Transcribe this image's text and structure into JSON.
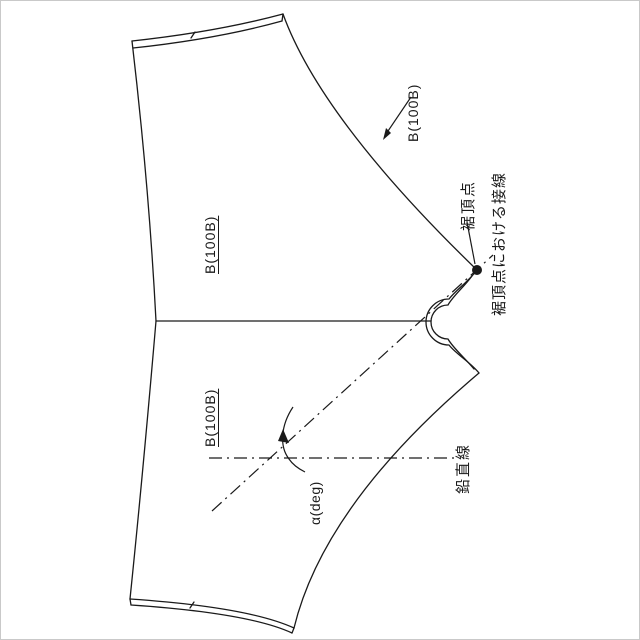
{
  "figure": {
    "type": "pattern-drafting-diagram",
    "description": "Rotated garment/umbrella gore pattern piece drawing with hem apex tangent and angle annotation",
    "labels": {
      "panel_ref_top_right": "B(100B)",
      "panel_ref_upper": "B(100B)",
      "panel_ref_lower": "B(100B)",
      "hem_apex_point": "裾頂点",
      "tangent_at_hem_apex": "裾頂点における接線",
      "vertical_line": "鉛直線",
      "angle": "α(deg)"
    },
    "markers": {
      "hem_apex_dot": "filled-circle",
      "line_style_chain": "dash-dot",
      "angle_indicator": "curved-arrow"
    },
    "colors": {
      "ink": "#1a1a1a",
      "bg": "#ffffff"
    }
  }
}
